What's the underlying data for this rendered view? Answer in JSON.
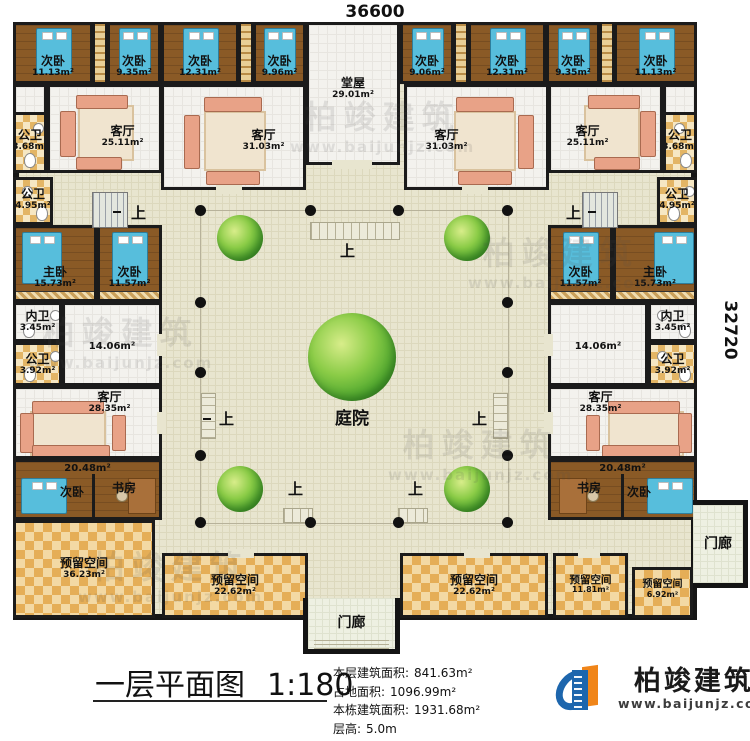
{
  "dimensions": {
    "top": "36600",
    "right": "32720"
  },
  "title": {
    "text": "一层平面图",
    "scale": "1:180"
  },
  "info": {
    "floor_area_label": "本层建筑面积:",
    "floor_area_value": "841.63m²",
    "land_area_label": "占地面积:",
    "land_area_value": "1096.99m²",
    "building_area_label": "本栋建筑面积:",
    "building_area_value": "1931.68m²",
    "storey_height_label": "层高:",
    "storey_height_value": "5.0m"
  },
  "logo": {
    "name": "柏竣建筑",
    "url": "www.baijunjz.com"
  },
  "watermark": {
    "name": "柏竣建筑",
    "url": "www.baijunjz.com"
  },
  "courtyard": {
    "label": "庭院",
    "step_label": "上"
  },
  "porch": {
    "label": "门廊"
  },
  "rooms": {
    "bedA1": {
      "label": "次卧",
      "area": "11.13m²"
    },
    "bedA2": {
      "label": "次卧",
      "area": "9.35m²"
    },
    "bedA3": {
      "label": "次卧",
      "area": "12.31m²"
    },
    "bedA4": {
      "label": "次卧",
      "area": "9.96m²"
    },
    "tangwu": {
      "label": "堂屋",
      "area": "29.01m²"
    },
    "bedB1": {
      "label": "次卧",
      "area": "9.06m²"
    },
    "bedB2": {
      "label": "次卧",
      "area": "12.31m²"
    },
    "bedB3": {
      "label": "次卧",
      "area": "9.35m²"
    },
    "bedB4": {
      "label": "次卧",
      "area": "11.13m²"
    },
    "bathTL": {
      "label": "公卫",
      "area": "3.68m²"
    },
    "bathTR": {
      "label": "公卫",
      "area": "3.68m²"
    },
    "livTL": {
      "label": "客厅",
      "area": "25.11m²"
    },
    "livTML": {
      "label": "客厅",
      "area": "31.03m²"
    },
    "livTMR": {
      "label": "客厅",
      "area": "31.03m²"
    },
    "livTR": {
      "label": "客厅",
      "area": "25.11m²"
    },
    "bathL2": {
      "label": "公卫",
      "area": "4.95m²"
    },
    "bathR2": {
      "label": "公卫",
      "area": "4.95m²"
    },
    "masterL": {
      "label": "主卧",
      "area": "15.73m²"
    },
    "bedWL": {
      "label": "次卧",
      "area": "11.57m²"
    },
    "bedWR": {
      "label": "次卧",
      "area": "11.57m²"
    },
    "masterR": {
      "label": "主卧",
      "area": "15.73m²"
    },
    "enbathL": {
      "label": "内卫",
      "area": "3.45m²"
    },
    "enbathR": {
      "label": "内卫",
      "area": "3.45m²"
    },
    "bathL3": {
      "label": "公卫",
      "area": "3.92m²"
    },
    "bathR3": {
      "label": "公卫",
      "area": "3.92m²"
    },
    "hallL": {
      "area": "14.06m²"
    },
    "hallR": {
      "area": "14.06m²"
    },
    "livWL": {
      "label": "客厅",
      "area": "28.35m²"
    },
    "livWR": {
      "label": "客厅",
      "area": "28.35m²"
    },
    "suiteL": {
      "area": "20.48m²",
      "bed_label": "次卧",
      "study_label": "书房"
    },
    "suiteR": {
      "area": "20.48m²",
      "bed_label": "次卧",
      "study_label": "书房"
    },
    "resL": {
      "label": "预留空间",
      "area": "36.23m²"
    },
    "resB1": {
      "label": "预留空间",
      "area": "22.62m²"
    },
    "resB2": {
      "label": "预留空间",
      "area": "22.62m²"
    },
    "resB3": {
      "label": "预留空间",
      "area": "11.81m²"
    },
    "resB4": {
      "label": "预留空间",
      "area": "6.92m²"
    }
  }
}
